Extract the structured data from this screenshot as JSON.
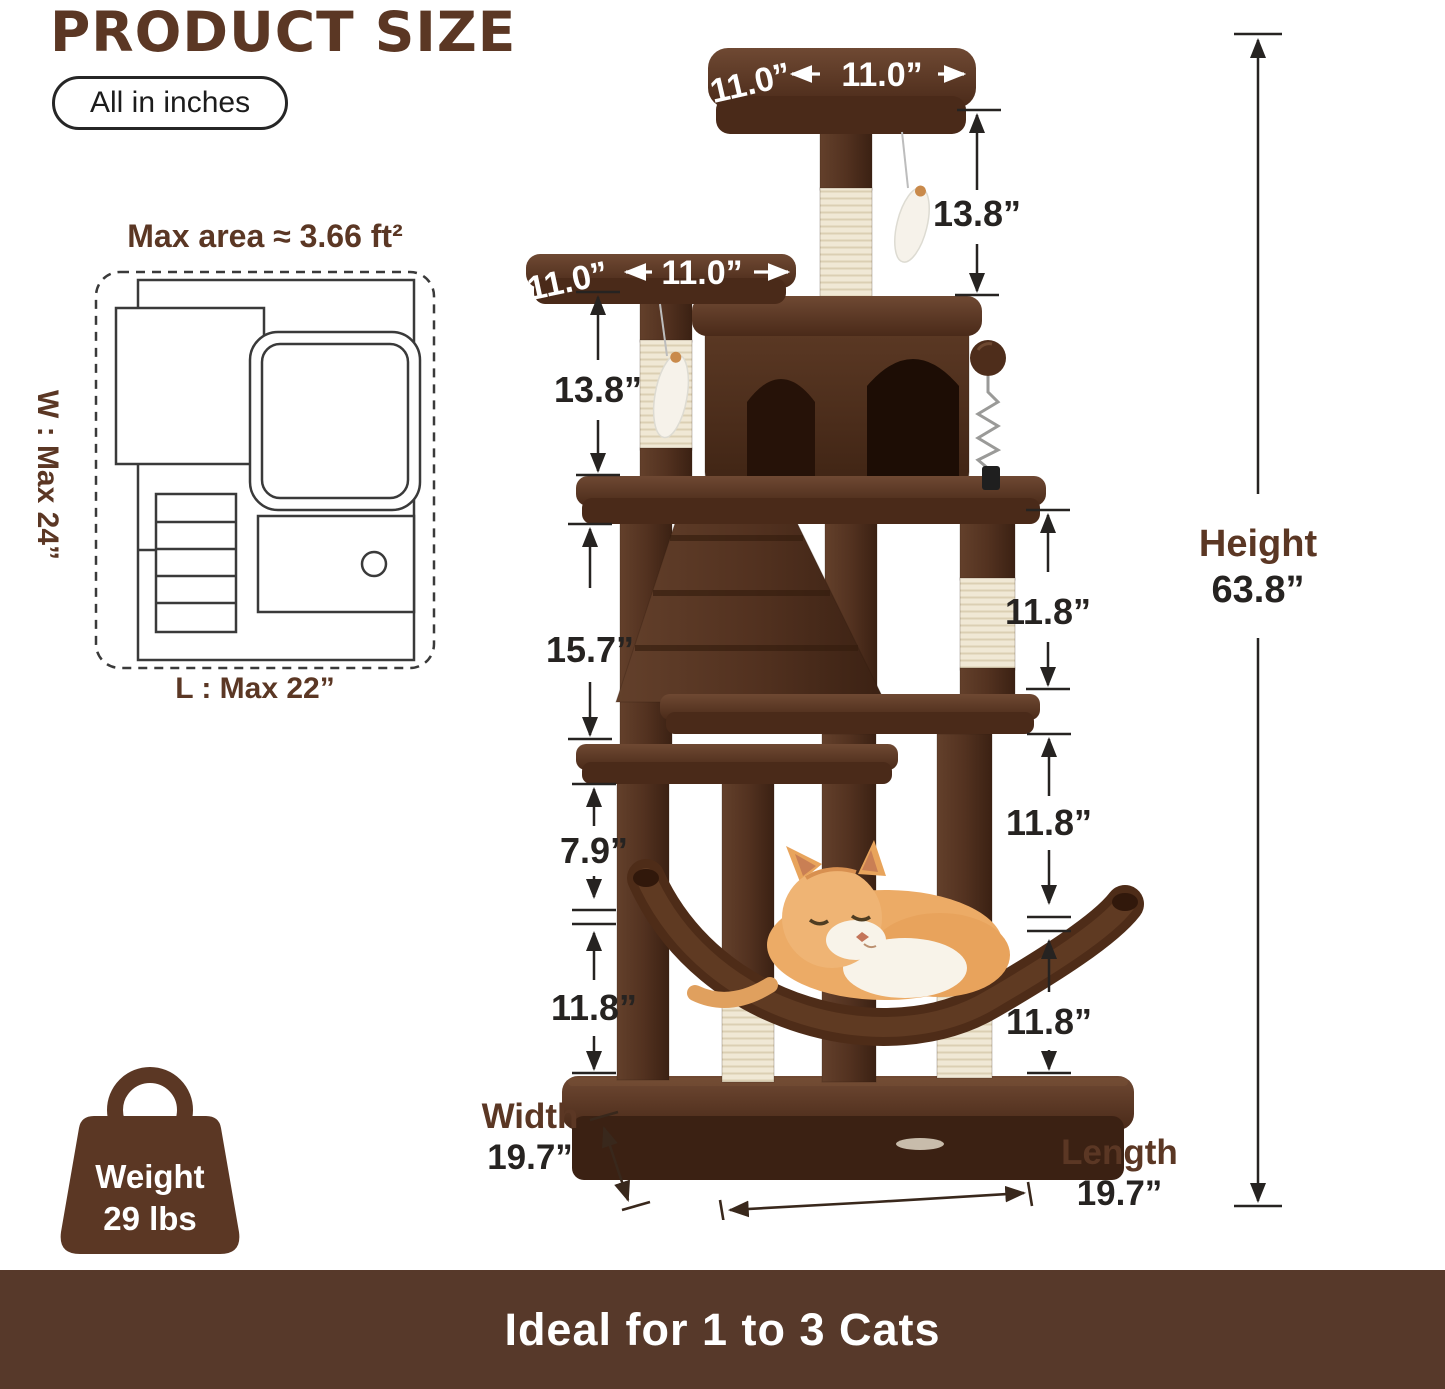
{
  "header": {
    "title": "PRODUCT SIZE",
    "unit_badge": "All in inches"
  },
  "floor_plan": {
    "title": "Max area ≈ 3.66 ft²",
    "max_width": "W : Max 24”",
    "max_length": "L : Max 22”"
  },
  "dimensions": {
    "top_platform_side": "11.0”",
    "top_platform_front": "11.0”",
    "second_platform_side": "11.0”",
    "second_platform_front": "11.0”",
    "top_post": "13.8”",
    "second_post": "13.8”",
    "upper_left": "15.7”",
    "upper_right": "11.8”",
    "mid_left": "7.9”",
    "mid_right": "11.8”",
    "lower_left": "11.8”",
    "lower_right": "11.8”",
    "height_label": "Height",
    "height_value": "63.8”",
    "width_label": "Width",
    "width_value": "19.7”",
    "length_label": "Length",
    "length_value": "19.7”"
  },
  "weight_badge": {
    "label": "Weight",
    "value": "29 lbs"
  },
  "footer": {
    "text": "Ideal for 1 to 3 Cats"
  },
  "colors": {
    "brand_brown": "#5b3724",
    "banner_brown": "#57392a",
    "dimension_text": "#262321",
    "sisal": "#f0e8d5",
    "plush_dark": "#3b2113"
  },
  "icons": {
    "weight_badge": "shopping-bag-icon"
  }
}
